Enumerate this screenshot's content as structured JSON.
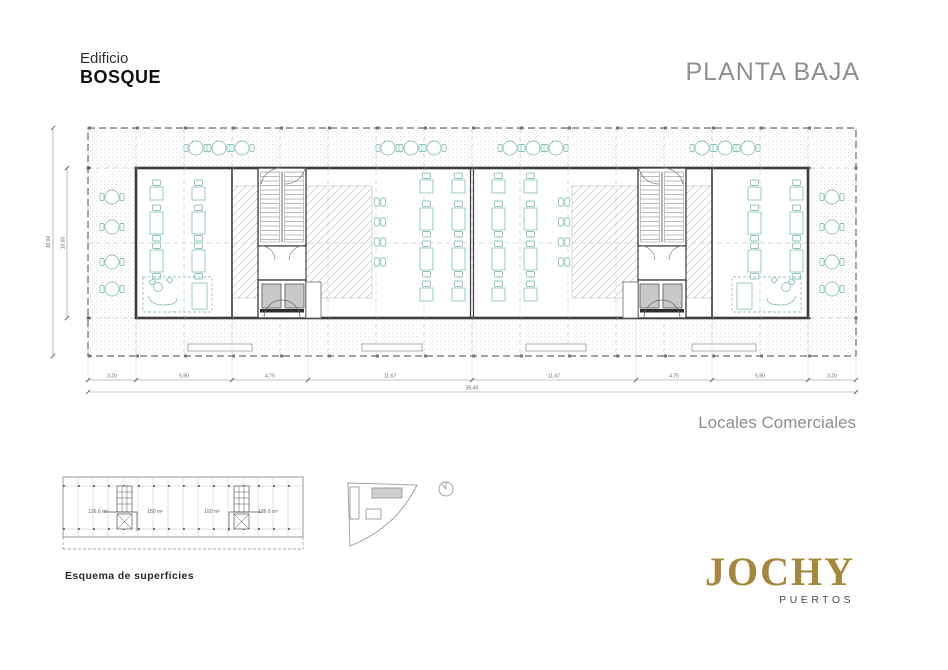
{
  "header": {
    "building_label": "Edificio",
    "building_name": "BOSQUE",
    "plan_title": "PLANTA BAJA"
  },
  "plan": {
    "caption": "Locales Comerciales",
    "dims_h": [
      "3.20",
      "5.90",
      "4.75",
      "11.67",
      "11.67",
      "4.75",
      "5.90",
      "3.20"
    ],
    "dim_total": "35.40",
    "dims_v": [
      "16.00",
      "10.00"
    ]
  },
  "esquema": {
    "title": "Esquema de superficies",
    "areas": [
      "136.6 m²",
      "150 m²",
      "150 m²",
      "136.6 m²"
    ]
  },
  "logo": {
    "name": "JOCHY",
    "subtitle": "PUERTOS"
  },
  "colors": {
    "furniture_teal": "#8fc4be",
    "logo_gold": "#a5883c",
    "muted_text": "#8f8f8f",
    "walls": "#3c3c3c",
    "elevator_fill": "#c8c8c8"
  }
}
